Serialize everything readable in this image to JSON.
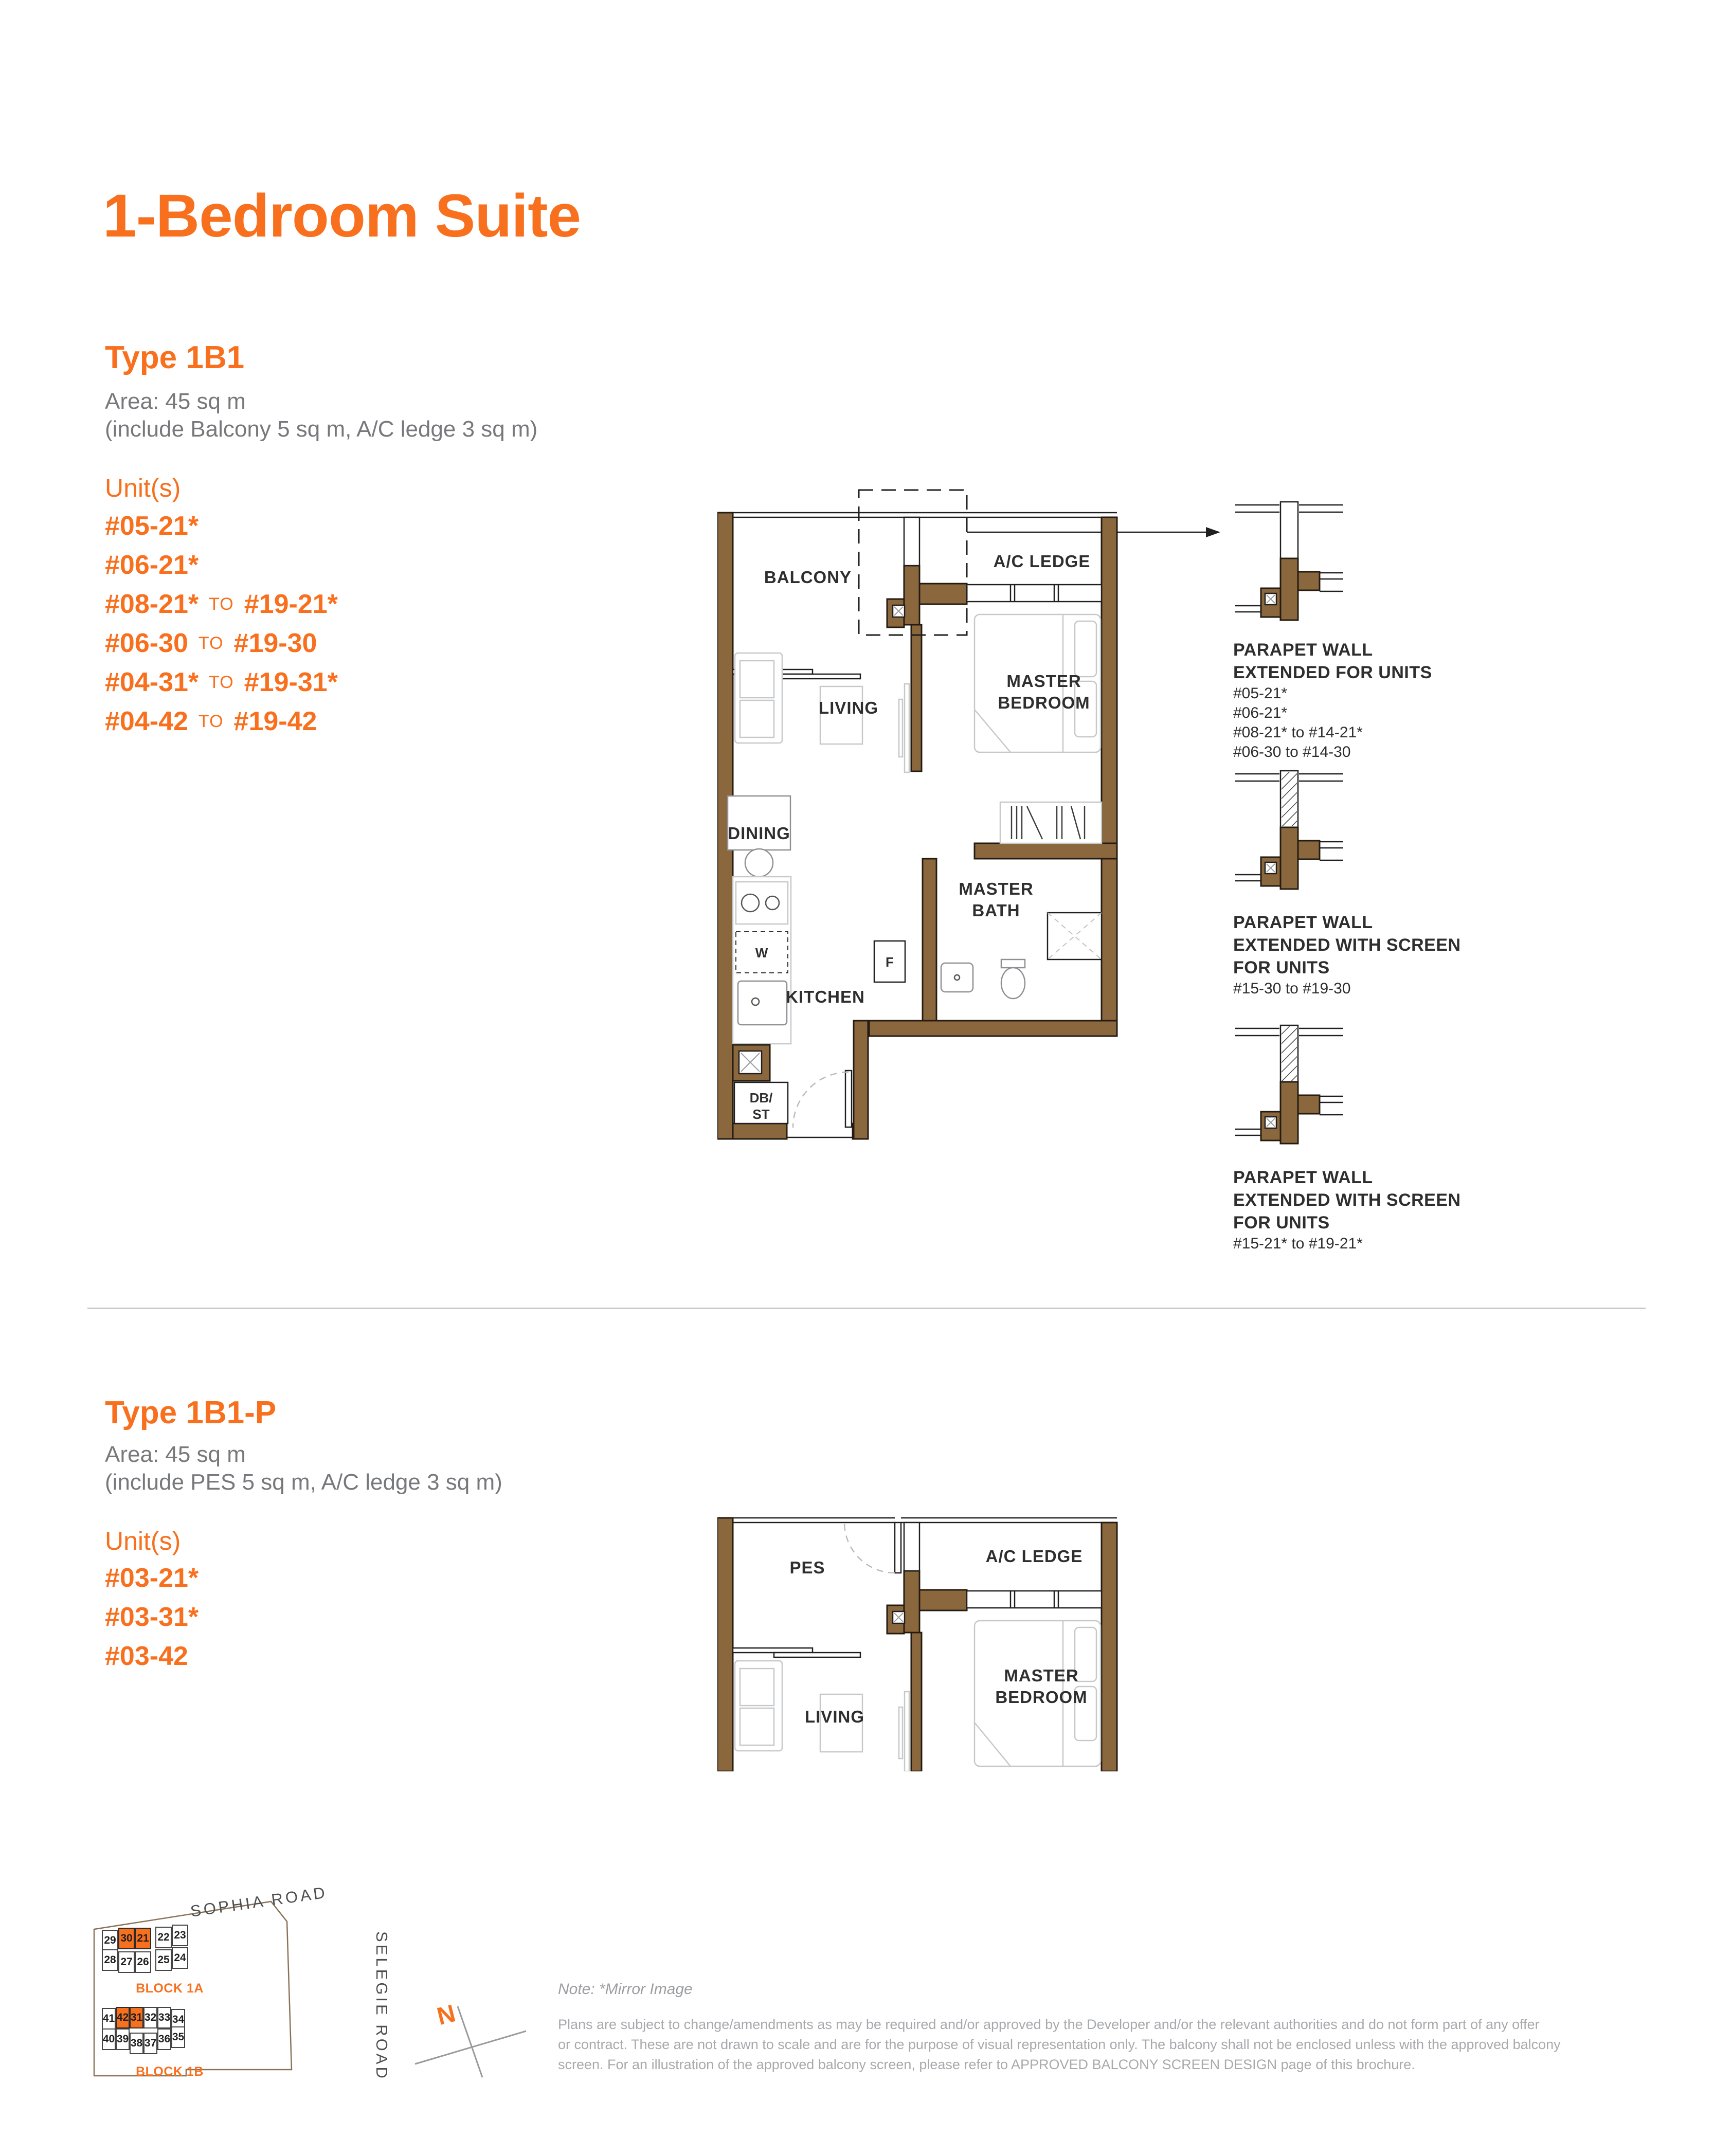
{
  "page": {
    "title": "1-Bedroom Suite"
  },
  "colors": {
    "orange": "#F8701E",
    "wall_brown": "#8B673E",
    "gray_text": "#77787B",
    "dark_text": "#2E2E2E"
  },
  "type1b1": {
    "heading": "Type 1B1",
    "area_line1": "Area: 45 sq m",
    "area_line2": "(include Balcony 5 sq m, A/C ledge 3 sq m)",
    "units_label": "Unit(s)",
    "to_word": "TO",
    "units": [
      {
        "from": "#05-21*",
        "to": ""
      },
      {
        "from": "#06-21*",
        "to": ""
      },
      {
        "from": "#08-21*",
        "to": "#19-21*"
      },
      {
        "from": "#06-30",
        "to": "#19-30"
      },
      {
        "from": "#04-31*",
        "to": "#19-31*"
      },
      {
        "from": "#04-42",
        "to": "#19-42"
      }
    ],
    "plan_labels": {
      "balcony": "BALCONY",
      "ac_ledge": "A/C LEDGE",
      "living": "LIVING",
      "master_bedroom": [
        "MASTER",
        "BEDROOM"
      ],
      "dining": "DINING",
      "master_bath": [
        "MASTER",
        "BATH"
      ],
      "kitchen": "KITCHEN",
      "fridge": "F",
      "washer": "W",
      "db_st": [
        "DB/",
        "ST"
      ]
    }
  },
  "parapet_notes": [
    {
      "screen": false,
      "title_lines": [
        "PARAPET WALL",
        "EXTENDED FOR UNITS"
      ],
      "units": [
        "#05-21*",
        "#06-21*",
        "#08-21* to #14-21*",
        "#06-30 to #14-30"
      ]
    },
    {
      "screen": true,
      "title_lines": [
        "PARAPET WALL",
        "EXTENDED WITH SCREEN",
        "FOR UNITS"
      ],
      "units": [
        "#15-30 to #19-30"
      ]
    },
    {
      "screen": true,
      "title_lines": [
        "PARAPET WALL",
        "EXTENDED WITH SCREEN",
        "FOR UNITS"
      ],
      "units": [
        "#15-21* to #19-21*"
      ]
    }
  ],
  "type1b1p": {
    "heading": "Type 1B1-P",
    "area_line1": "Area: 45 sq m",
    "area_line2": "(include PES 5 sq m, A/C ledge 3 sq m)",
    "units_label": "Unit(s)",
    "units": [
      "#03-21*",
      "#03-31*",
      "#03-42"
    ],
    "plan_labels": {
      "pes": "PES",
      "ac_ledge": "A/C LEDGE",
      "living": "LIVING",
      "master_bedroom": [
        "MASTER",
        "BEDROOM"
      ]
    }
  },
  "sitemap": {
    "roads": {
      "top": "SOPHIA ROAD",
      "right": "SELEGIE ROAD"
    },
    "north_label": "N",
    "blocks": [
      {
        "label": "BLOCK 1A",
        "row1": [
          {
            "n": "29",
            "hl": false
          },
          {
            "n": "30",
            "hl": true
          },
          {
            "n": "21",
            "hl": true
          },
          {
            "n": "22",
            "hl": false
          },
          {
            "n": "23",
            "hl": false
          }
        ],
        "row2": [
          {
            "n": "28",
            "hl": false
          },
          {
            "n": "27",
            "hl": false
          },
          {
            "n": "26",
            "hl": false
          },
          {
            "n": "25",
            "hl": false
          },
          {
            "n": "24",
            "hl": false
          }
        ]
      },
      {
        "label": "BLOCK 1B",
        "row1": [
          {
            "n": "41",
            "hl": false
          },
          {
            "n": "42",
            "hl": true
          },
          {
            "n": "31",
            "hl": true
          },
          {
            "n": "32",
            "hl": false
          },
          {
            "n": "33",
            "hl": false
          },
          {
            "n": "34",
            "hl": false
          }
        ],
        "row2": [
          {
            "n": "40",
            "hl": false
          },
          {
            "n": "39",
            "hl": false
          },
          {
            "n": "38",
            "hl": false
          },
          {
            "n": "37",
            "hl": false
          },
          {
            "n": "36",
            "hl": false
          },
          {
            "n": "35",
            "hl": false
          }
        ]
      }
    ]
  },
  "notes": {
    "mirror": "Note: *Mirror Image",
    "disclaimer": [
      "Plans are subject to change/amendments as may be required and/or approved by the Developer and/or the relevant authorities and do not form part of any offer",
      "or contract. These are not drawn to scale and are for the purpose of visual representation only. The balcony shall not be enclosed unless with the approved balcony",
      "screen. For an illustration of the approved balcony screen,  please refer to APPROVED BALCONY SCREEN DESIGN page of this brochure."
    ]
  }
}
